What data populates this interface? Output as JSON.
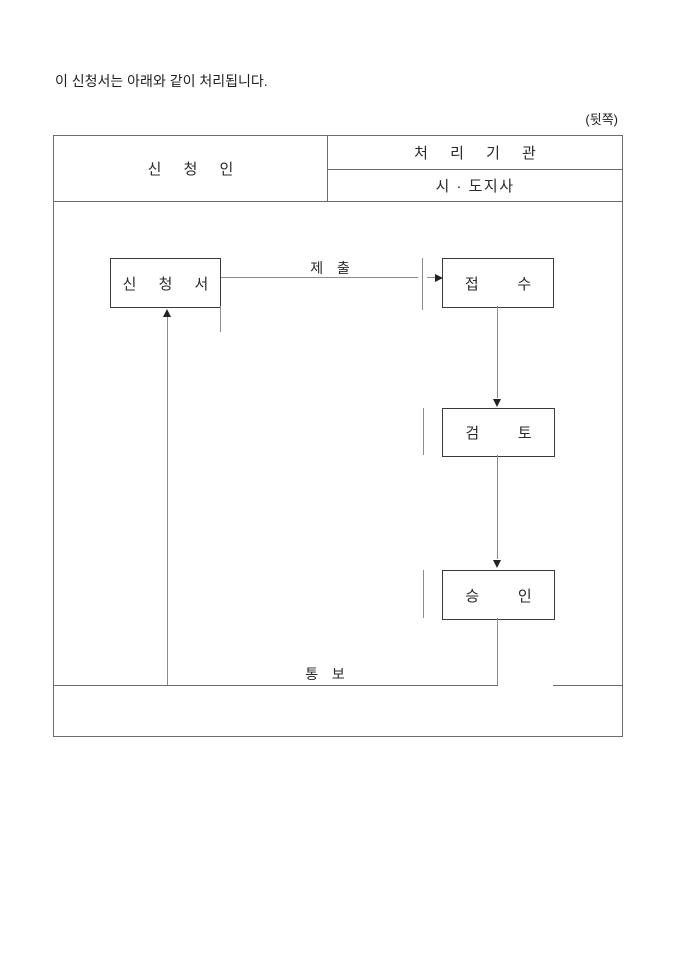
{
  "page": {
    "intro_text": "이 신청서는 아래와 같이 처리됩니다.",
    "back_label": "(뒷쪽)"
  },
  "table": {
    "applicant_header": "신 청 인",
    "agency_header": "처 리 기 관",
    "agency_subheader": "시 · 도지사"
  },
  "flowchart": {
    "application_box": "신 청 서",
    "submit_label": "제 출",
    "receipt_box": "접 수",
    "review_box": "검 토",
    "approval_box": "승 인",
    "notify_label": "통 보"
  },
  "colors": {
    "table_line": "#6b6b6b",
    "connector_line": "#8c8c8c",
    "box_border": "#3a3a3a",
    "text": "#1f1f1f",
    "background": "#ffffff"
  }
}
